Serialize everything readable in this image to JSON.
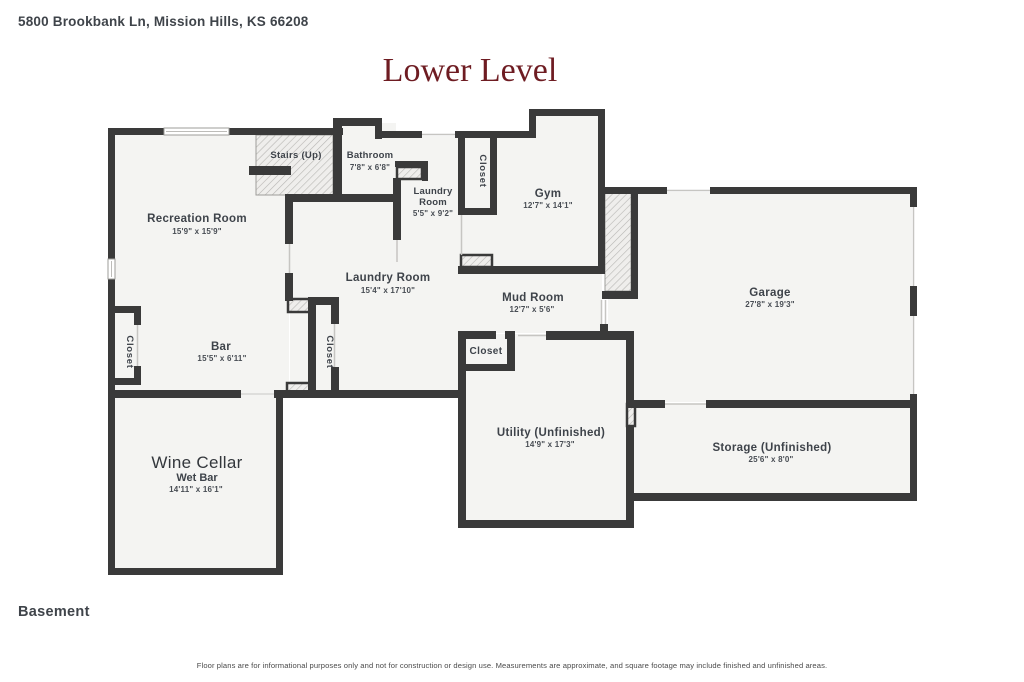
{
  "header": {
    "address": "5800 Brookbank Ln, Mission Hills, KS 66208",
    "title": "Lower Level"
  },
  "rooms": {
    "recreation": {
      "name": "Recreation Room",
      "dims": "15'9\" x 15'9\""
    },
    "stairs": {
      "name": "Stairs (Up)"
    },
    "bathroom": {
      "name": "Bathroom",
      "dims": "7'8\" x 6'8\""
    },
    "laundry_small": {
      "name_line1": "Laundry",
      "name_line2": "Room",
      "dims": "5'5\" x 9'2\""
    },
    "closet_top": {
      "name": "Closet"
    },
    "gym": {
      "name": "Gym",
      "dims": "12'7\" x 14'1\""
    },
    "laundry_large": {
      "name": "Laundry Room",
      "dims": "15'4\" x 17'10\""
    },
    "mud_room": {
      "name": "Mud Room",
      "dims": "12'7\" x 5'6\""
    },
    "garage": {
      "name": "Garage",
      "dims": "27'8\" x 19'3\""
    },
    "bar": {
      "name": "Bar",
      "dims": "15'5\" x 6'11\""
    },
    "closet_left": {
      "name": "Closet"
    },
    "closet_middle": {
      "name": "Closet"
    },
    "closet_mudroom": {
      "name": "Closet"
    },
    "wine_cellar": {
      "name": "Wine Cellar",
      "subtitle": "Wet Bar",
      "dims": "14'11\" x 16'1\""
    },
    "utility": {
      "name": "Utility (Unfinished)",
      "dims": "14'9\" x 17'3\""
    },
    "storage": {
      "name": "Storage (Unfinished)",
      "dims": "25'6\" x 8'0\""
    }
  },
  "footer": {
    "level_label": "Basement",
    "disclaimer": "Floor plans are for informational purposes only and not for construction or design use. Measurements are approximate, and square footage may include finished and unfinished areas."
  },
  "colors": {
    "wall": "#3a3a3a",
    "room_fill": "#f4f4f2",
    "title_accent": "#6e1c22",
    "label_text": "#3e434a"
  }
}
